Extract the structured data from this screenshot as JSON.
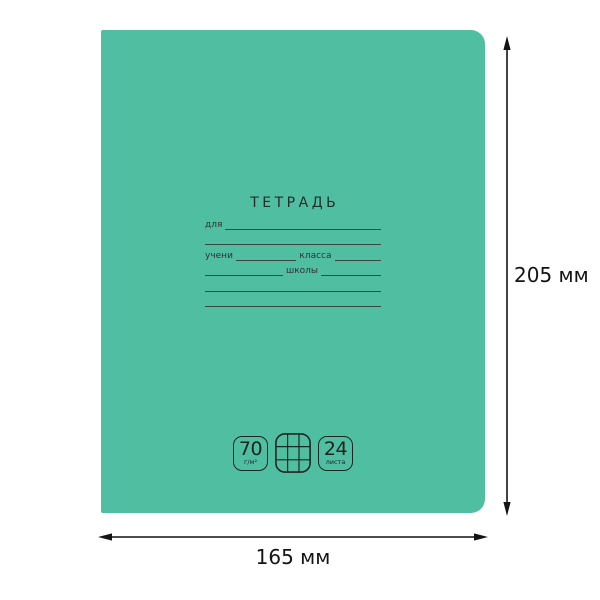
{
  "cover": {
    "title": "ТЕТРАДЬ",
    "color": "#50BFA1",
    "form": {
      "for_label": "для",
      "student_label": "учени",
      "class_label": "класса",
      "school_label": "школы"
    },
    "badges": {
      "density": {
        "value": "70",
        "unit": "г/м²"
      },
      "grid_icon": "squared-paper-icon",
      "sheets": {
        "value": "24",
        "unit": "листа"
      }
    }
  },
  "dimensions": {
    "height": "205 мм",
    "width": "165 мм"
  }
}
